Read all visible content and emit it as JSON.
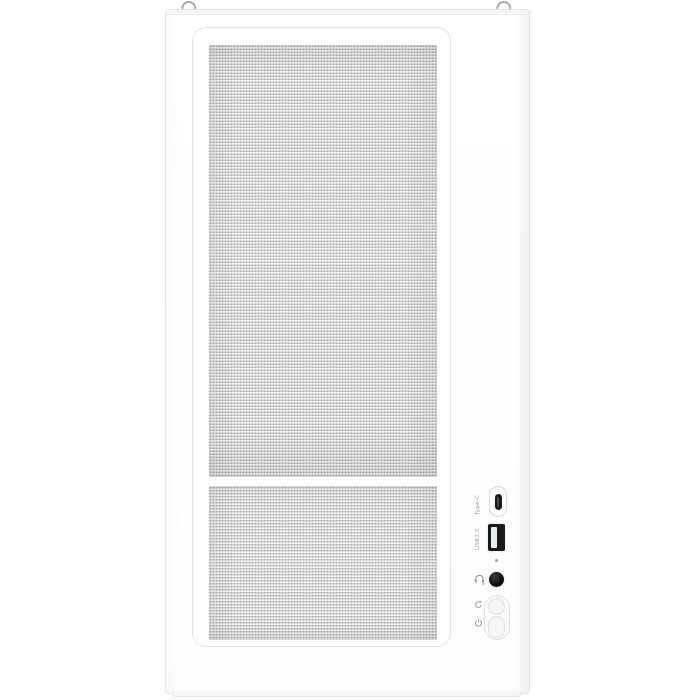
{
  "scene": {
    "subject": "White mid-tower PC case, front view product photo",
    "panel": "perforated mesh front panel in two sections",
    "background": "plain white"
  },
  "colors": {
    "background": "#ffffff",
    "case-body": "#fdfdfd",
    "edge-line": "#e7e7e7",
    "bezel-border": "#e3e3e3",
    "mesh-base": "#e2e2e2",
    "mesh-dot": "#a6a6a6",
    "port-black": "#1a1a1a",
    "usb-tab": "#e7ecef",
    "metal-gray": "#9c9c9c",
    "label-gray": "#9b9b9b"
  },
  "io_panel": {
    "labels": {
      "usb_c": "Type-C",
      "usb_a": "USB3.0"
    },
    "ports": [
      "usb-type-c",
      "usb-3.0-type-a",
      "headphone-microphone-jack"
    ],
    "indicators": [
      "led-hole"
    ],
    "buttons": [
      "reset",
      "power"
    ],
    "icons": [
      "headset-icon",
      "reset-icon",
      "power-icon"
    ]
  },
  "hardware": {
    "top_features": [
      "handle-loop-left",
      "handle-loop-right"
    ]
  }
}
